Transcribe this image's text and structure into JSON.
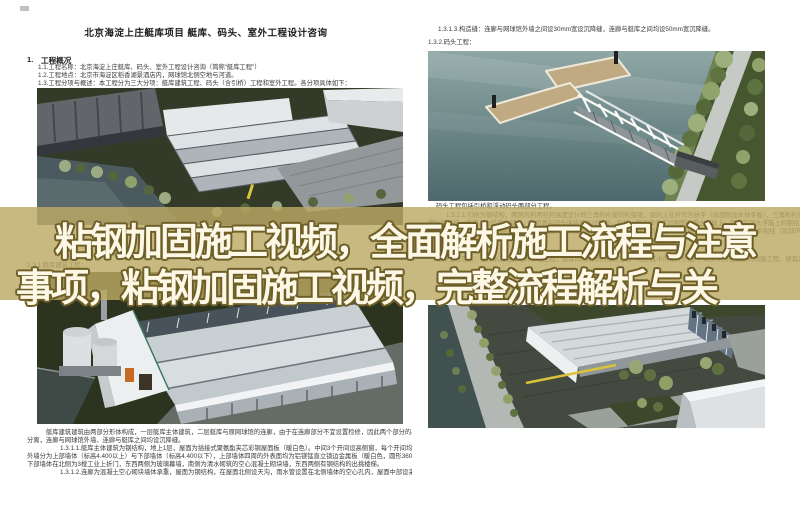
{
  "overlay": {
    "line1": "粘钢加固施工视频，全面解析施工流程与注意",
    "line2": "事项，粘钢加固施工视频，完整流程解析与关",
    "band_color": "rgba(188,170,100,0.82)",
    "text_color": "#fdf8e6",
    "outline_color": "#6e5f28"
  },
  "left_page": {
    "title": "北京海淀上庄艇库项目 艇库、码头、室外工程设计咨询",
    "heading_no": "1.",
    "heading": "工程概况",
    "intro": [
      "1.1.工程名称：北京海淀上庄艇库、码头、室外工程设计咨询（简称“艇库工程”）",
      "1.2.工程地点：北京市海淀区稻香湖景酒店内，网球馆北侧空地与河道。",
      "1.3.工程分项与概述：本工程分为三大分项：艇库建筑工程、码头（含引桥）工程和室外工程。各分项具体如下："
    ],
    "sub_heading": "1.3.1.艇库建筑工程：",
    "body": [
      "艇库建筑建筑由两部分形体构成，一层艇库主体建筑，二层艇库与原网球馆的连廊，由于在连廊部分不宜设置检修，因此两个部分的基础、结构",
      "分离，连廊与网球馆外墙、连廊与艇库之间均设沉降缝。",
      "1.3.1.1.艇库主体建筑为钢结构，地上1层，屋面为插接式聚氨酯夹芯彩钢屋面板（暖白色）。中间3个开间设高侧窗，每个开间均设排水天沟，",
      "外墙分为上部墙体（标高4.400以上）与下部墙体（标高4.400以下），上部墙体四周的外表面均为铝镁锰直立锁边金属板（暖白色，圆形360度锁边），",
      "下部墙体在北侧为3樘工业上折门，东西两侧为玻璃幕墙，南侧为清水砌筑的空心混凝土砌块墙，东西两侧有钢结构的出挑楼梯。",
      "1.3.1.2.连廊为混凝土空心砌块墙体承重，屋面为钢结构，在屋面北侧设天沟，雨水管设置在北侧墙体的空心孔内，屋面中部设采光天窗。"
    ]
  },
  "right_page": {
    "line_structural": "1.3.1.3.构造缝：连廊与网球馆外墙之间设30mm宽设沉降缝，连廊与艇库之间均设50mm宽沉降缝。",
    "heading_dock": "1.3.2.码头工程：",
    "para": [
      "码头工程包括引桥和浮动码头两部分工程。",
      "1.3.2.1.引桥为钢结构，两侧为利用栏杆高度设计的三角形桁架的桁架梁，梁的上弦杆作为扶手（局部附加木扶手板），三角形桁架梁之间",
      "横桁架连接，桥面上为防腐木铺装，在桥面与码头连接处设过渡段，引桥一端支承于岸边钢筋混凝土基础上，固定在码头浮箱上的钢结构基座上。",
      "1.3.2.2.浮动码头为钢结构浮箱拼装而成，码头面层为防腐木铺装，码头与引桥之间设连接过渡段，码头四周设置系船柱（局部环保面层）。",
      "1.3.3.室外工程：",
      "室外工程包括：给排水及强弱电的外线工程，艇库四周场地的铺装工程（包括其中的室外小品），码头引桥至道路的甬路工程，移栽及新种树木"
    ]
  }
}
